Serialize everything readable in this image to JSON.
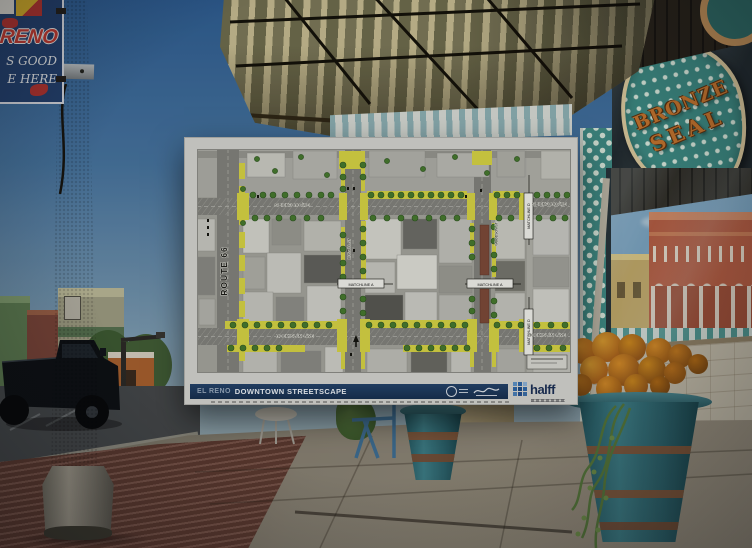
{
  "scene": {
    "lamp_banner": {
      "city": "RENO",
      "tag1": "S GOOD",
      "tag2": "E HERE"
    },
    "storefront_sign": {
      "word1": "BRONZE",
      "word2": "SEAL"
    }
  },
  "poster": {
    "title_bar": {
      "location": "EL RENO",
      "title": "DOWNTOWN STREETSCAPE"
    },
    "brand": {
      "name": "halff"
    },
    "map": {
      "route": "ROUTE 66",
      "bickford_left": "S BICKFORD AVE",
      "bickford_right": "S BICKFORD AVE",
      "rock_island_left": "ROCK ISLAND AVE",
      "rock_island_right": "ROCK ISLAND AVE",
      "russell": "RUSSELL ST",
      "woodson": "WOODSON ST",
      "matchline_a_left": "MATCHLINE A",
      "matchline_a_right": "MATCHLINE A",
      "matchline_d_top": "MATCHLINE D",
      "matchline_d_bottom": "MATCHLINE D"
    },
    "colors": {
      "improvement_yellow": "#d8d545",
      "tree_green": "#477a2e",
      "bar_navy": "#1c3552",
      "halff_blue": "#2e66a8"
    }
  }
}
